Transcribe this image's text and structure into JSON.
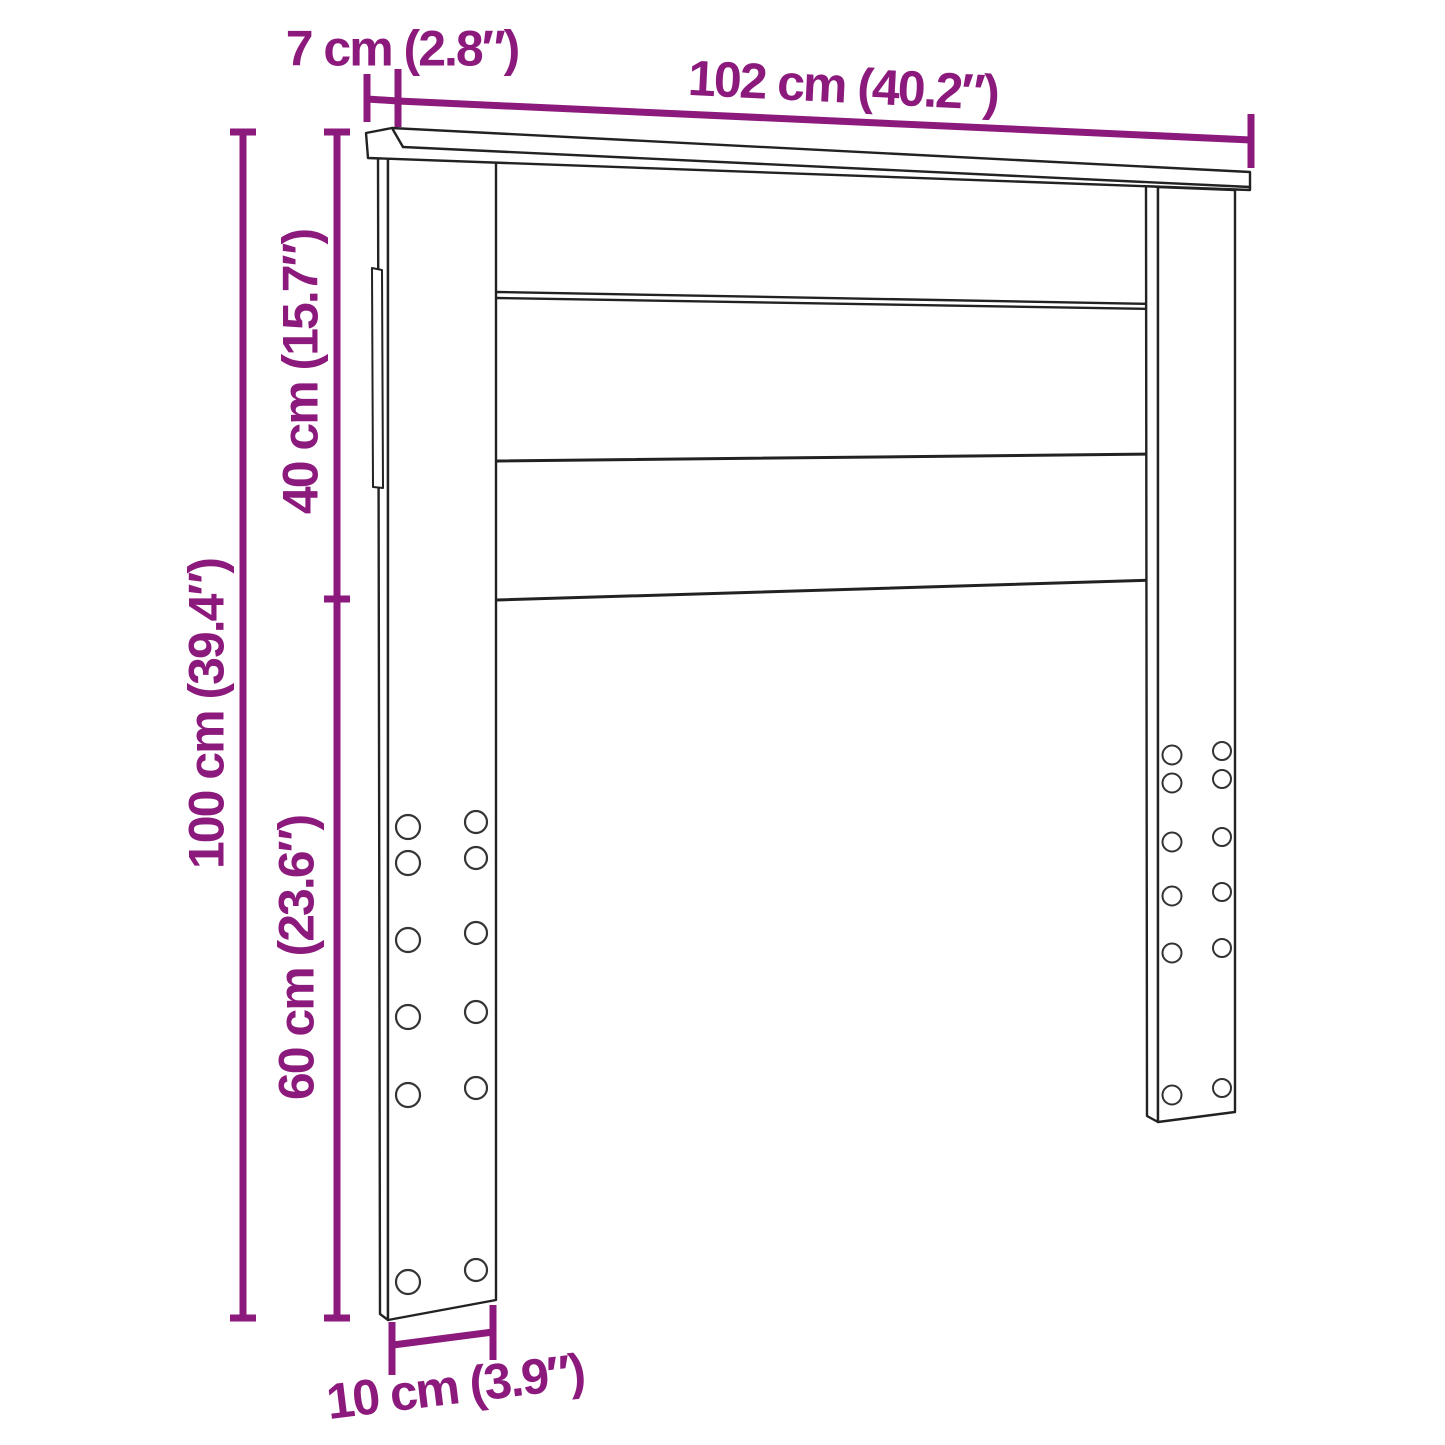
{
  "diagram": {
    "type": "furniture-dimension-diagram",
    "product": "headboard",
    "colors": {
      "dimension": "#8C1A7D",
      "line": "#222222",
      "seam": "#333333",
      "background": "#ffffff"
    },
    "dimensions": {
      "top_depth": "7 cm (2.8″)",
      "width": "102 cm (40.2″)",
      "panel_height": "40 cm (15.7″)",
      "total_height": "100 cm (39.4″)",
      "leg_height": "60 cm (23.6″)",
      "leg_width": "10 cm (3.9″)"
    }
  }
}
